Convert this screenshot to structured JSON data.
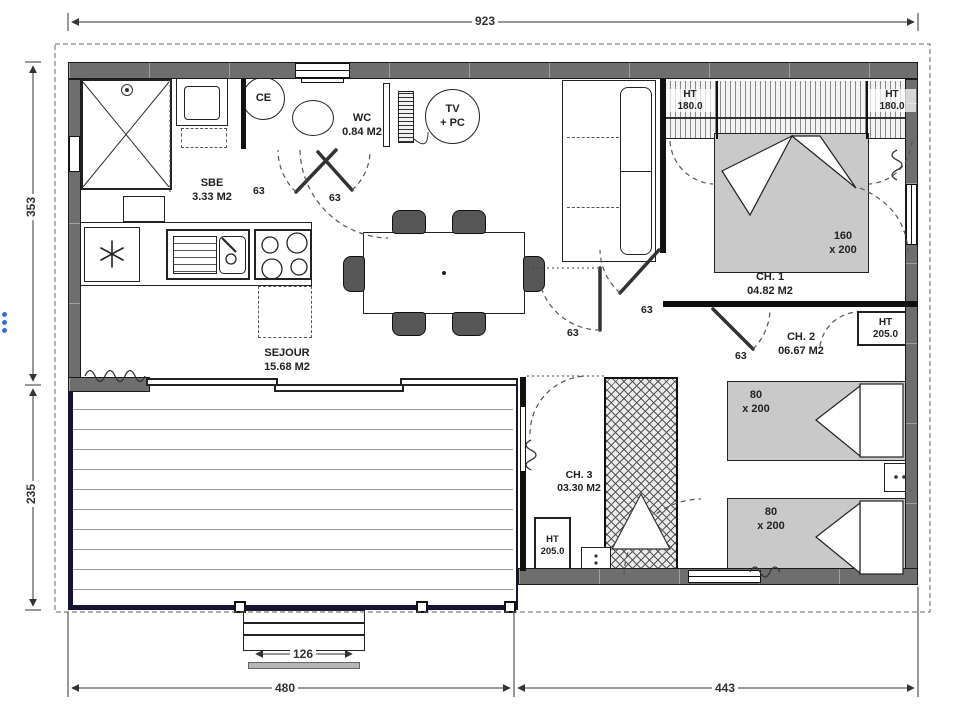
{
  "plan": {
    "dimensions": {
      "overall_width": "923",
      "left_upper": "353",
      "left_lower": "235",
      "bottom_left": "480",
      "bottom_right": "443",
      "steps_width": "126"
    },
    "rooms": {
      "sbe": {
        "name": "SBE",
        "area": "3.33 M2"
      },
      "wc": {
        "name": "WC",
        "area": "0.84 M2"
      },
      "sejour": {
        "name": "SEJOUR",
        "area": "15.68 M2"
      },
      "ch1": {
        "name": "CH. 1",
        "area": "04.82 M2"
      },
      "ch2": {
        "name": "CH. 2",
        "area": "06.67 M2"
      },
      "ch3": {
        "name": "CH. 3",
        "area": "03.30 M2"
      }
    },
    "equipment": {
      "water_heater": "CE",
      "tv_line1": "TV",
      "tv_line2": "+ PC"
    },
    "wardrobes": {
      "ch1_left": {
        "line1": "HT",
        "line2": "180.0"
      },
      "ch1_right": {
        "line1": "HT",
        "line2": "180.0"
      },
      "ch2": {
        "line1": "HT",
        "line2": "205.0"
      },
      "ch3": {
        "line1": "HT",
        "line2": "205.0"
      }
    },
    "beds": {
      "ch1": {
        "line1": "160",
        "line2": "x 200"
      },
      "ch2": {
        "line1": "80",
        "line2": "x 200"
      },
      "ch3": {
        "line1": "80",
        "line2": "x 200"
      }
    },
    "doors": {
      "sbe": "63",
      "wc": "63",
      "ch1": "63",
      "ch2": "63",
      "ch3": "63"
    }
  },
  "colors": {
    "wall": "#6e6e6e",
    "bed": "#c9c9c9",
    "terrace_frame": "#151533",
    "dimension": "#333333",
    "accent_blue": "#3a6fd8"
  }
}
